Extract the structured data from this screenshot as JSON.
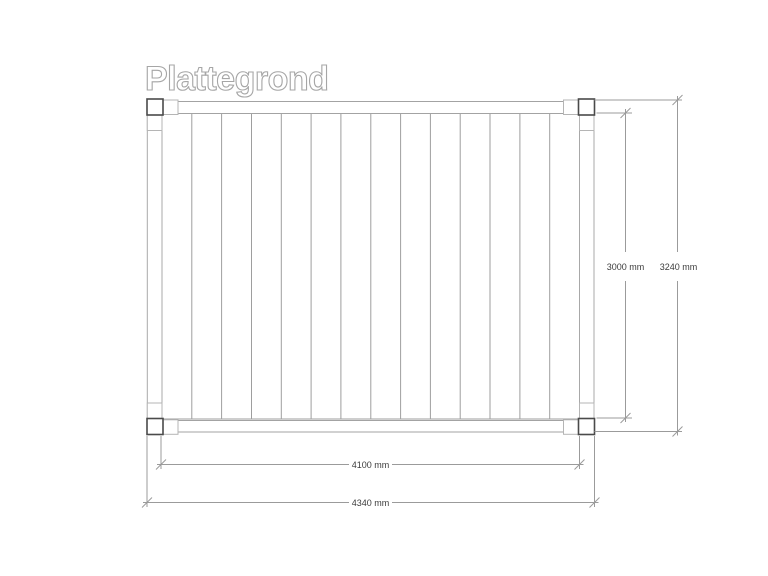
{
  "title": "Plattegrond",
  "drawing": {
    "type": "floor-plan",
    "unit": "mm",
    "dimensions": {
      "inner_height_label": "3000 mm",
      "outer_height_label": "3240 mm",
      "inner_width_label": "4100 mm",
      "outer_width_label": "4340 mm"
    },
    "structure": {
      "corner_posts": 4,
      "planks": 14,
      "inner_span_mm": {
        "width": 4100,
        "height": 3000
      },
      "outer_span_mm": {
        "width": 4340,
        "height": 3240
      }
    },
    "colors": {
      "background": "#ffffff",
      "line": "#a3a3a3",
      "post_line": "#4a4a4a",
      "dimension_line": "#9b9b9b",
      "dimension_text": "#3c3c3c",
      "title_outline": "#a6a6a6"
    }
  }
}
